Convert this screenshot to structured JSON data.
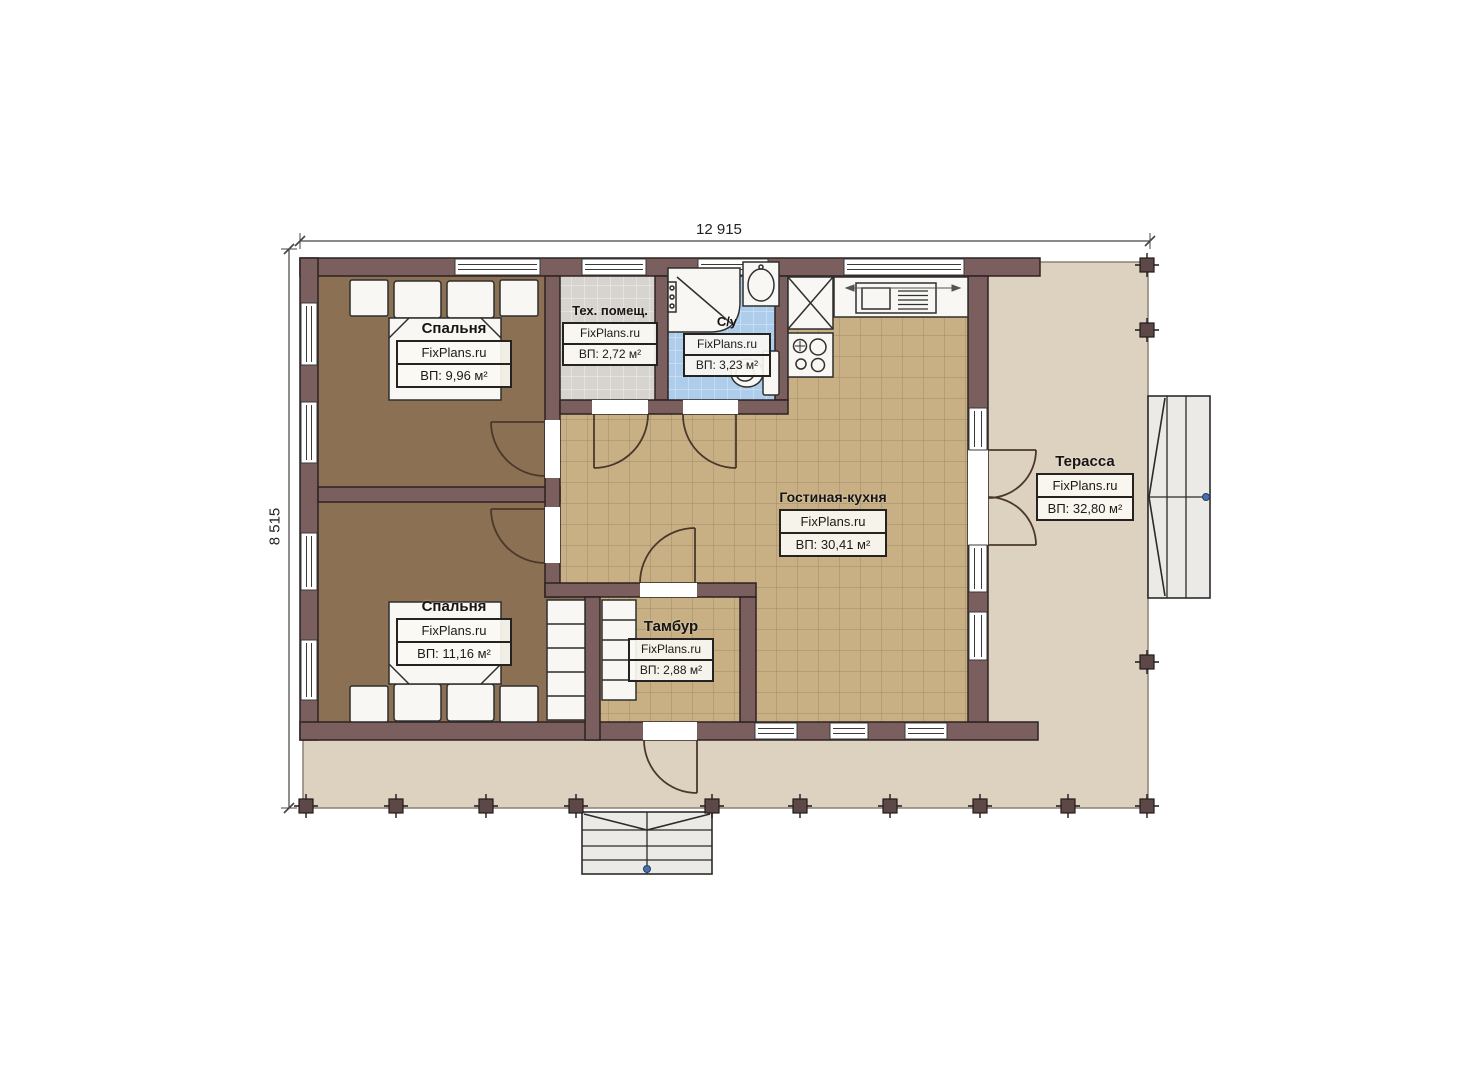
{
  "plan_title": "floor-plan",
  "dimensions": {
    "width_label": "12 915",
    "height_label": "8 515"
  },
  "rooms": [
    {
      "id": "bedroom-1",
      "name": "Спальня",
      "watermark": "FixPlans.ru",
      "area": "ВП: 9,96 м²"
    },
    {
      "id": "tech-room",
      "name": "Тех. помещ.",
      "watermark": "FixPlans.ru",
      "area": "ВП: 2,72 м²"
    },
    {
      "id": "bathroom",
      "name": "С/у",
      "watermark": "FixPlans.ru",
      "area": "ВП: 3,23 м²"
    },
    {
      "id": "living-kitchen",
      "name": "Гостиная-кухня",
      "watermark": "FixPlans.ru",
      "area": "ВП: 30,41 м²"
    },
    {
      "id": "terrace",
      "name": "Терасса",
      "watermark": "FixPlans.ru",
      "area": "ВП: 32,80 м²"
    },
    {
      "id": "bedroom-2",
      "name": "Спальня",
      "watermark": "FixPlans.ru",
      "area": "ВП: 11,16 м²"
    },
    {
      "id": "tambour",
      "name": "Тамбур",
      "watermark": "FixPlans.ru",
      "area": "ВП: 2,88 м²"
    }
  ],
  "colors": {
    "wall": "#7b5f5f",
    "wall_outline": "#2d2222",
    "bedroom_floor": "#8b7053",
    "tile_tan": "#c8b084",
    "tile_gray": "#d7d4cf",
    "tile_blue": "#aecdea",
    "terrace_floor": "#ddd2c0",
    "stairs_fill": "#eceae6",
    "door_arc": "#4a382c",
    "marker_blue": "#4a6ea8"
  }
}
